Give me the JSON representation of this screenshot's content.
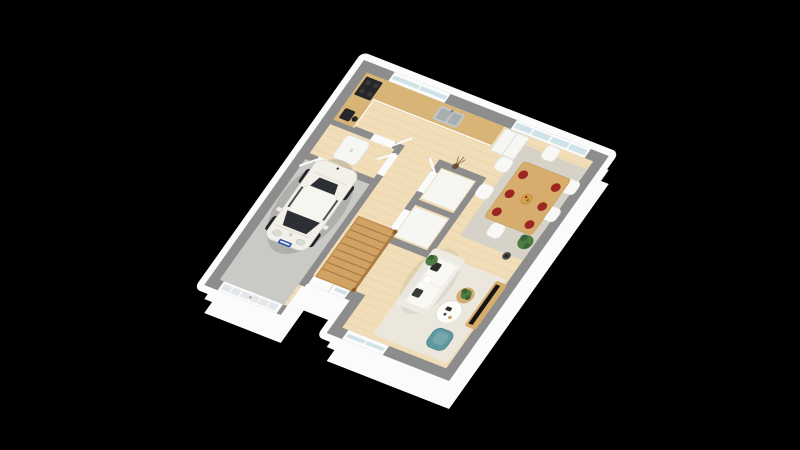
{
  "scene": {
    "title": "3D isometric render of a ground-floor plan: garage with white city car, wooden staircase, kitchen with L-shaped counter, dining area with six chairs, and living room with sofa, TV and teal armchair, on a black background",
    "background": "#000000",
    "view": "isometric-3d-render",
    "colors": {
      "wallTop": "#8d8d8d",
      "wallFace": "#fbfbfb",
      "woodFloor": "#f1ddb7",
      "plankLine": "#e3caa0",
      "garageFloor": "#c9c9c6",
      "rugDining": "#d7d2c8",
      "rugLiving": "#ebe7dd",
      "counterTop": "#d9b477",
      "cabinetWhite": "#f6f6f3",
      "sinkSteel": "#c2c7ca",
      "applianceDark": "#26262a",
      "tableWood": "#d7ad6e",
      "chairWhite": "#f8f8f6",
      "plateRed": "#9c2722",
      "bowlOrange": "#d9a04a",
      "sofaWhite": "#f1efe9",
      "cushionWhite": "#faf8f3",
      "pillowDark": "#2d2d2d",
      "tvBlack": "#141414",
      "armchairTeal": "#5f99a0",
      "plantGreen": "#4e7c45",
      "plantDark": "#3c6436",
      "stairWood": "#d2a263",
      "stairEdge": "#a87c45",
      "carBody": "#f2f0e9",
      "carGlass": "#2c3034",
      "plateBlue": "#2b50a8",
      "garageDoor": "#e4e7e9",
      "glassBlue": "#cfe2e8"
    },
    "rooms": [
      {
        "name": "garage"
      },
      {
        "name": "entrance-hall"
      },
      {
        "name": "kitchen"
      },
      {
        "name": "dining-area"
      },
      {
        "name": "living-room"
      },
      {
        "name": "wc-storage"
      },
      {
        "name": "staircase-corridor"
      }
    ],
    "objects": [
      "white-city-car",
      "garage-door",
      "water-heater",
      "wooden-staircase",
      "kitchen-counter",
      "cooktop",
      "coffee-machine",
      "sink",
      "fridge",
      "kitchen-window",
      "glass-bay-window",
      "dining-table",
      "dining-chairs-x6",
      "red-plates-x6",
      "fruit-bowl",
      "dining-rug",
      "floor-lamp",
      "potted-plants",
      "sofa",
      "coffee-table",
      "side-table",
      "tv",
      "tv-bench",
      "living-rug",
      "teal-armchair",
      "living-window",
      "entry-door",
      "interior-doors",
      "decorative-vase"
    ],
    "counts": {
      "dining_chairs": 6,
      "red_plates": 6
    }
  }
}
